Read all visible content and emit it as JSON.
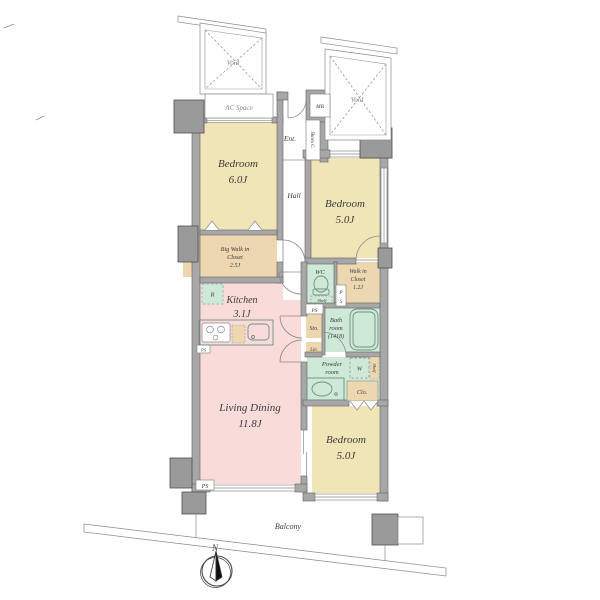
{
  "plan": {
    "rooms": {
      "bedroom1": {
        "name": "Bedroom",
        "size": "6.0J"
      },
      "bedroom2": {
        "name": "Bedroom",
        "size": "5.0J"
      },
      "bedroom3": {
        "name": "Bedroom",
        "size": "5.0J"
      },
      "living_dining": {
        "name": "Living Dining",
        "size": "11.8J"
      },
      "kitchen": {
        "name": "Kitchen",
        "size": "3.1J"
      },
      "big_walk_in_closet": {
        "line1": "Big Walk in",
        "line2": "Closet",
        "size": "2.5J"
      },
      "walk_in_closet": {
        "line1": "Walk in",
        "line2": "Closet",
        "size": "1.2J"
      },
      "bathroom": {
        "line1": "Bath",
        "line2": "room",
        "size": "(1418)"
      },
      "powder_room": {
        "line1": "Powder",
        "line2": "room"
      },
      "hall": {
        "name": "Hall"
      },
      "entrance": {
        "name": "Ent."
      },
      "wc": {
        "name": "WC"
      },
      "balcony": {
        "name": "Balcony"
      }
    },
    "labels": {
      "void": "Void",
      "ac_space": "AC Space",
      "meter_box": "MB",
      "shoes_cabinet": "Shoes C.",
      "shelf": "Shelf",
      "storage": "Sto.",
      "linen": "Lin.",
      "closet": "Clo.",
      "pipe_space": "PS",
      "pipe_space_p": "P",
      "pipe_space_s": "S",
      "refrigerator": "R",
      "washer": "W",
      "north": "N"
    },
    "colors": {
      "bedroom_fill": "#f0e5b6",
      "closet_fill": "#ecd7b0",
      "living_fill": "#f9dcda",
      "wet_area_fill": "#cfe9d9",
      "wall_fill": "#a7a7a7",
      "wall_edge": "#5f5f5f"
    }
  }
}
